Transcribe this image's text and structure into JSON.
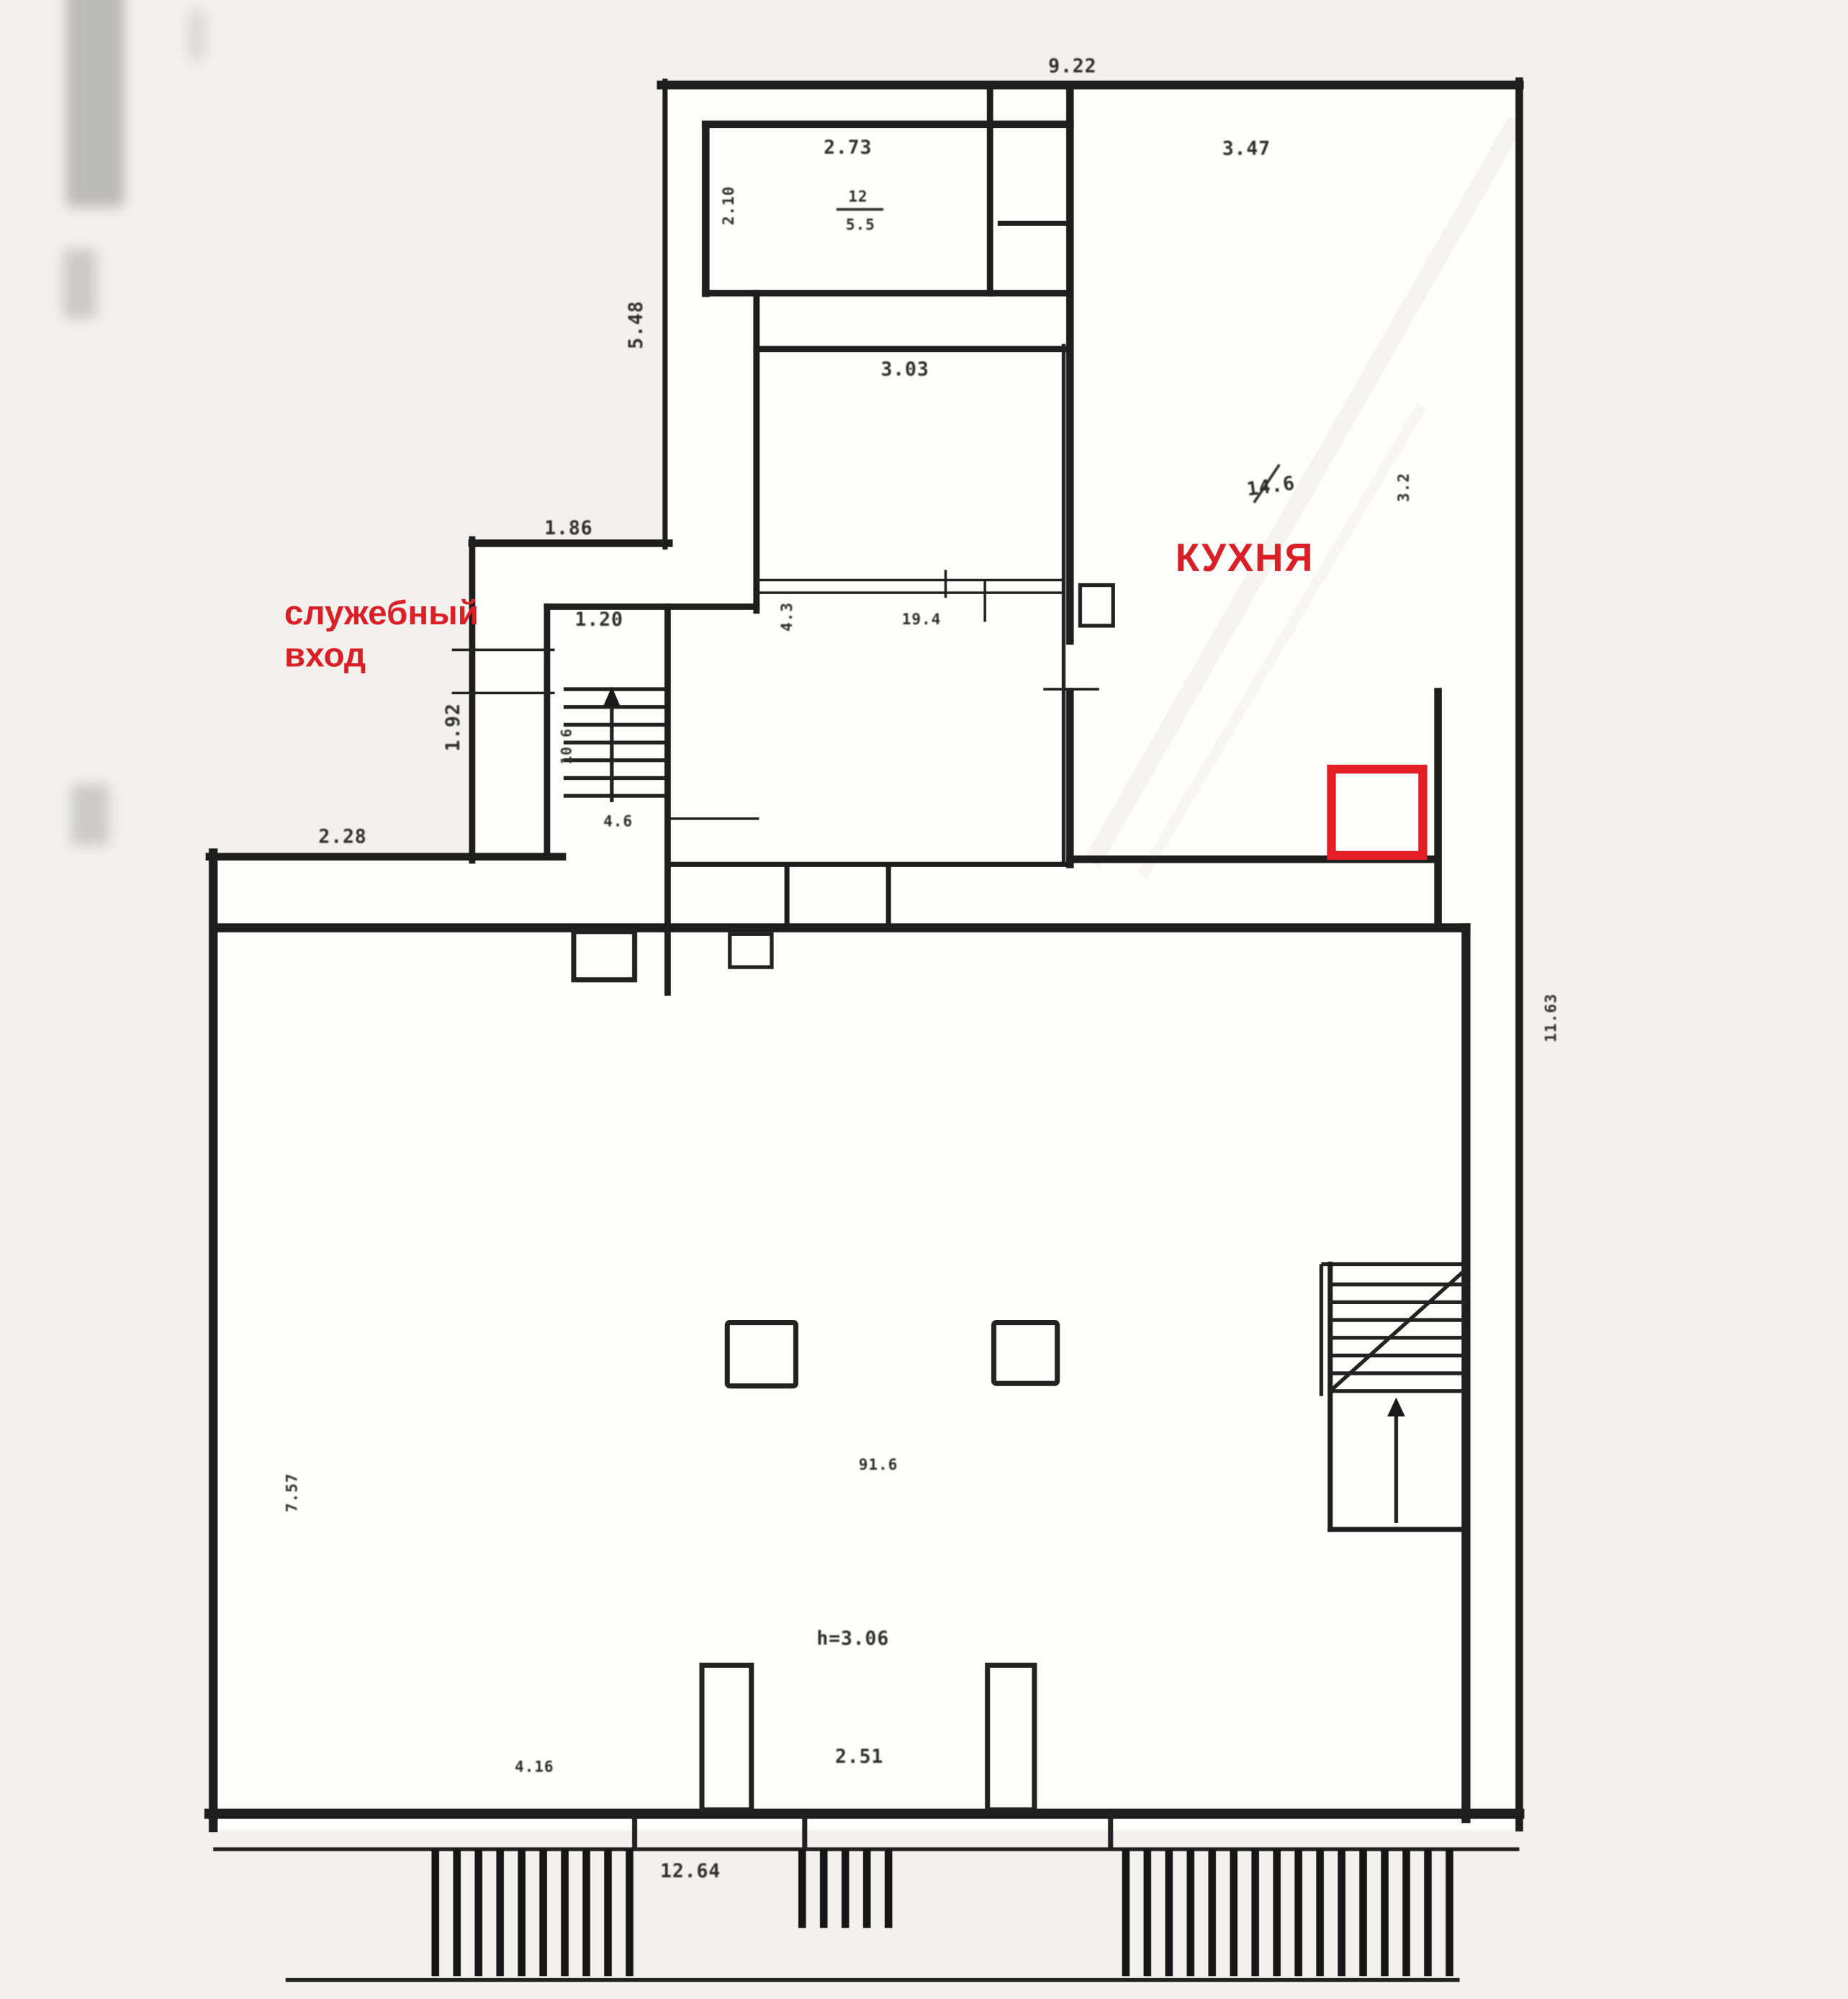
{
  "document": {
    "kind": "scanned floor plan"
  },
  "red_annotations": {
    "service_entrance_line1": "служебный",
    "service_entrance_line2": "вход",
    "kitchen_label": "КУХНЯ",
    "highlight_color": "#da1f26"
  },
  "rooms": {
    "room12_number": "12",
    "room12_area": "5.5",
    "room19_area": "19.4",
    "kitchen_area": "14.6",
    "hall_area": "91.6",
    "stairs_area": "4.6",
    "stairs_width": "10.6",
    "hall_height_note": "h=3.06"
  },
  "dims": {
    "top_width": "9.22",
    "room12_width": "2.73",
    "room12_depth": "2.10",
    "kitchen_width": "3.47",
    "left_upper_wall": "5.48",
    "middle_room_width": "3.03",
    "kitchen_depth": "3.2",
    "step_width": "1.86",
    "corridor_width": "1.20",
    "corridor_depth": "1.92",
    "middle_room_side": "4.3",
    "ledge_width": "2.28",
    "right_wall_height": "11.63",
    "left_wall_height": "7.57",
    "pillar_spacing": "2.51",
    "bottom_left_width": "4.16",
    "bottom_width": "12.64"
  },
  "colors": {
    "wall": "#1e1e1e",
    "paper": "#f1f0ec",
    "plan_background": "#fefefd",
    "dimension_text": "#2f2f2f",
    "annotation_red": "#da1f26"
  }
}
